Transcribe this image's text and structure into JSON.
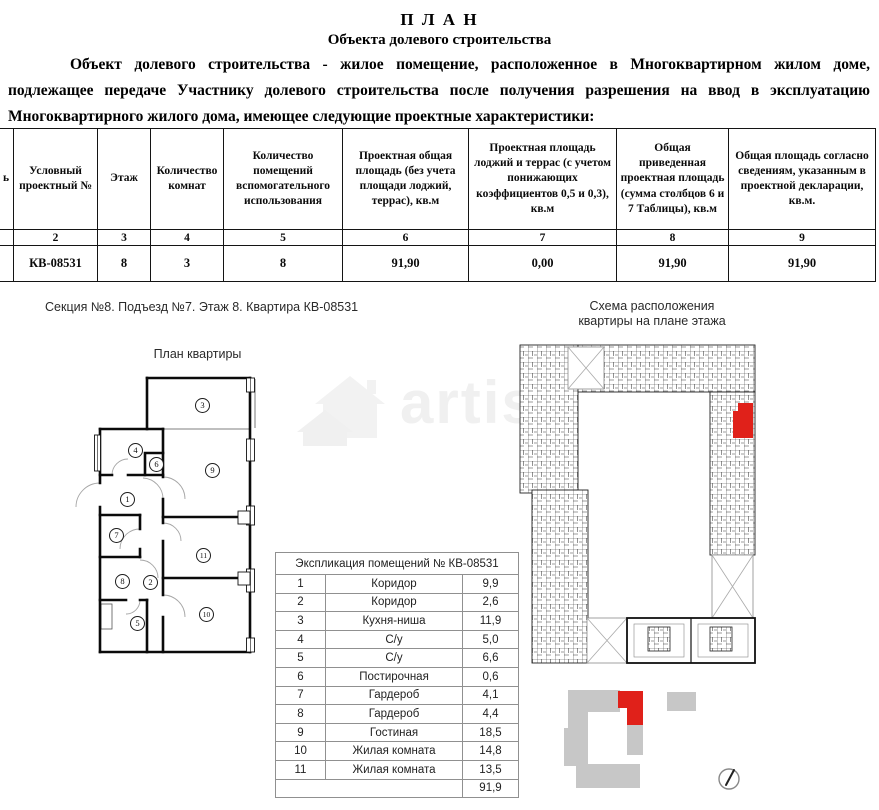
{
  "doc": {
    "title": "П Л А Н",
    "subtitle": "Объекта долевого строительства",
    "paragraph_lines": [
      "Объект долевого строительства - жилое помещение, расположенное в Многоквартирном жилом доме,",
      "подлежащее передаче Участнику долевого строительства после получения разрешения на ввод в эксплуатацию",
      "Многоквартирного жилого дома, имеющее следующие проектные характеристики:"
    ]
  },
  "main_table": {
    "headers": [
      "ь",
      "Условный проектный №",
      "Этаж",
      "Количество комнат",
      "Количество помещений вспомогательного использования",
      "Проектная общая площадь (без учета площади лоджий, террас), кв.м",
      "Проектная площадь лоджий и террас (с учетом понижающих коэффициентов 0,5 и 0,3), кв.м",
      "Общая приведенная проектная площадь (сумма столбцов 6 и 7 Таблицы), кв.м",
      "Общая площадь согласно сведениям, указанным в проектной декларации, кв.м."
    ],
    "numbers": [
      "",
      "2",
      "3",
      "4",
      "5",
      "6",
      "7",
      "8",
      "9"
    ],
    "row": [
      "",
      "КВ-08531",
      "8",
      "3",
      "8",
      "91,90",
      "0,00",
      "91,90",
      "91,90"
    ]
  },
  "section_label": "Секция №8. Подъезд №7. Этаж 8. Квартира КВ-08531",
  "plan_label": "План квартиры",
  "scheme_label": {
    "line1": "Схема расположения",
    "line2": "квартиры на плане этажа"
  },
  "floor_plan": {
    "rooms": [
      "1",
      "2",
      "3",
      "4",
      "5",
      "6",
      "7",
      "8",
      "9",
      "10",
      "11"
    ]
  },
  "explication": {
    "title": "Экспликация помещений № КВ-08531",
    "rows": [
      {
        "n": "1",
        "name": "Коридор",
        "area": "9,9"
      },
      {
        "n": "2",
        "name": "Коридор",
        "area": "2,6"
      },
      {
        "n": "3",
        "name": "Кухня-ниша",
        "area": "11,9"
      },
      {
        "n": "4",
        "name": "С/у",
        "area": "5,0"
      },
      {
        "n": "5",
        "name": "С/у",
        "area": "6,6"
      },
      {
        "n": "6",
        "name": "Постирочная",
        "area": "0,6"
      },
      {
        "n": "7",
        "name": "Гардероб",
        "area": "4,1"
      },
      {
        "n": "8",
        "name": "Гардероб",
        "area": "4,4"
      },
      {
        "n": "9",
        "name": "Гостиная",
        "area": "18,5"
      },
      {
        "n": "10",
        "name": "Жилая комната",
        "area": "14,8"
      },
      {
        "n": "11",
        "name": "Жилая комната",
        "area": "13,5"
      }
    ],
    "total": "91,9"
  },
  "watermark": {
    "text": "artis"
  },
  "colors": {
    "highlight_red": "#e0211a",
    "site_gray": "#c7c7c7"
  }
}
